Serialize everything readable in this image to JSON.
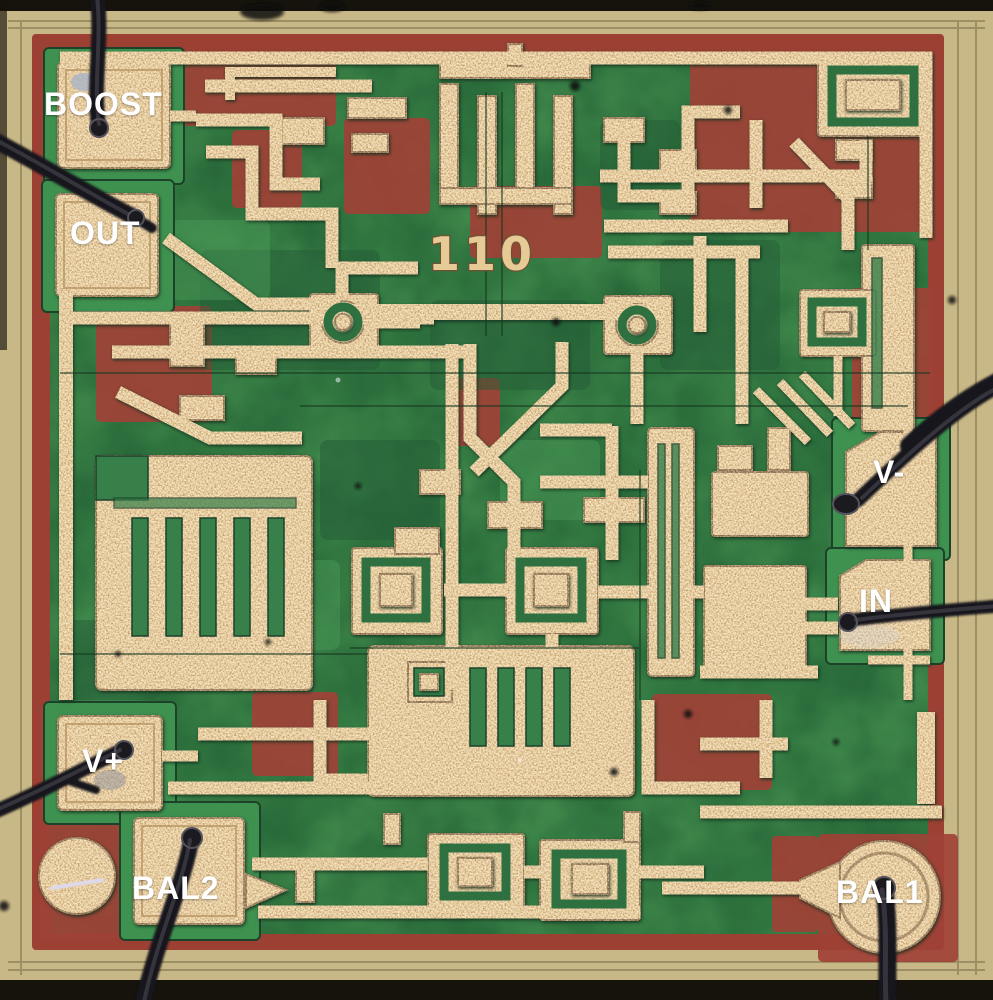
{
  "image": {
    "kind": "integrated-circuit die photograph",
    "die_marking": "110",
    "pad_count": 7
  },
  "pad_labels": [
    {
      "id": "boost",
      "label": "BOOST"
    },
    {
      "id": "out",
      "label": "OUT"
    },
    {
      "id": "v-minus",
      "label": "V-"
    },
    {
      "id": "in",
      "label": "IN"
    },
    {
      "id": "v-plus",
      "label": "V+"
    },
    {
      "id": "bal2",
      "label": "BAL2"
    },
    {
      "id": "bal1",
      "label": "BAL1"
    }
  ],
  "colors": {
    "scribe_lane": "#c9b887",
    "passivation_green": "#30753f",
    "diffusion_red": "#a04136",
    "metal": "#e9cf9e",
    "bond_wire": "#17161a",
    "pad_label_text": "#ffffff",
    "die_marking_metal": "#e7cb96"
  }
}
